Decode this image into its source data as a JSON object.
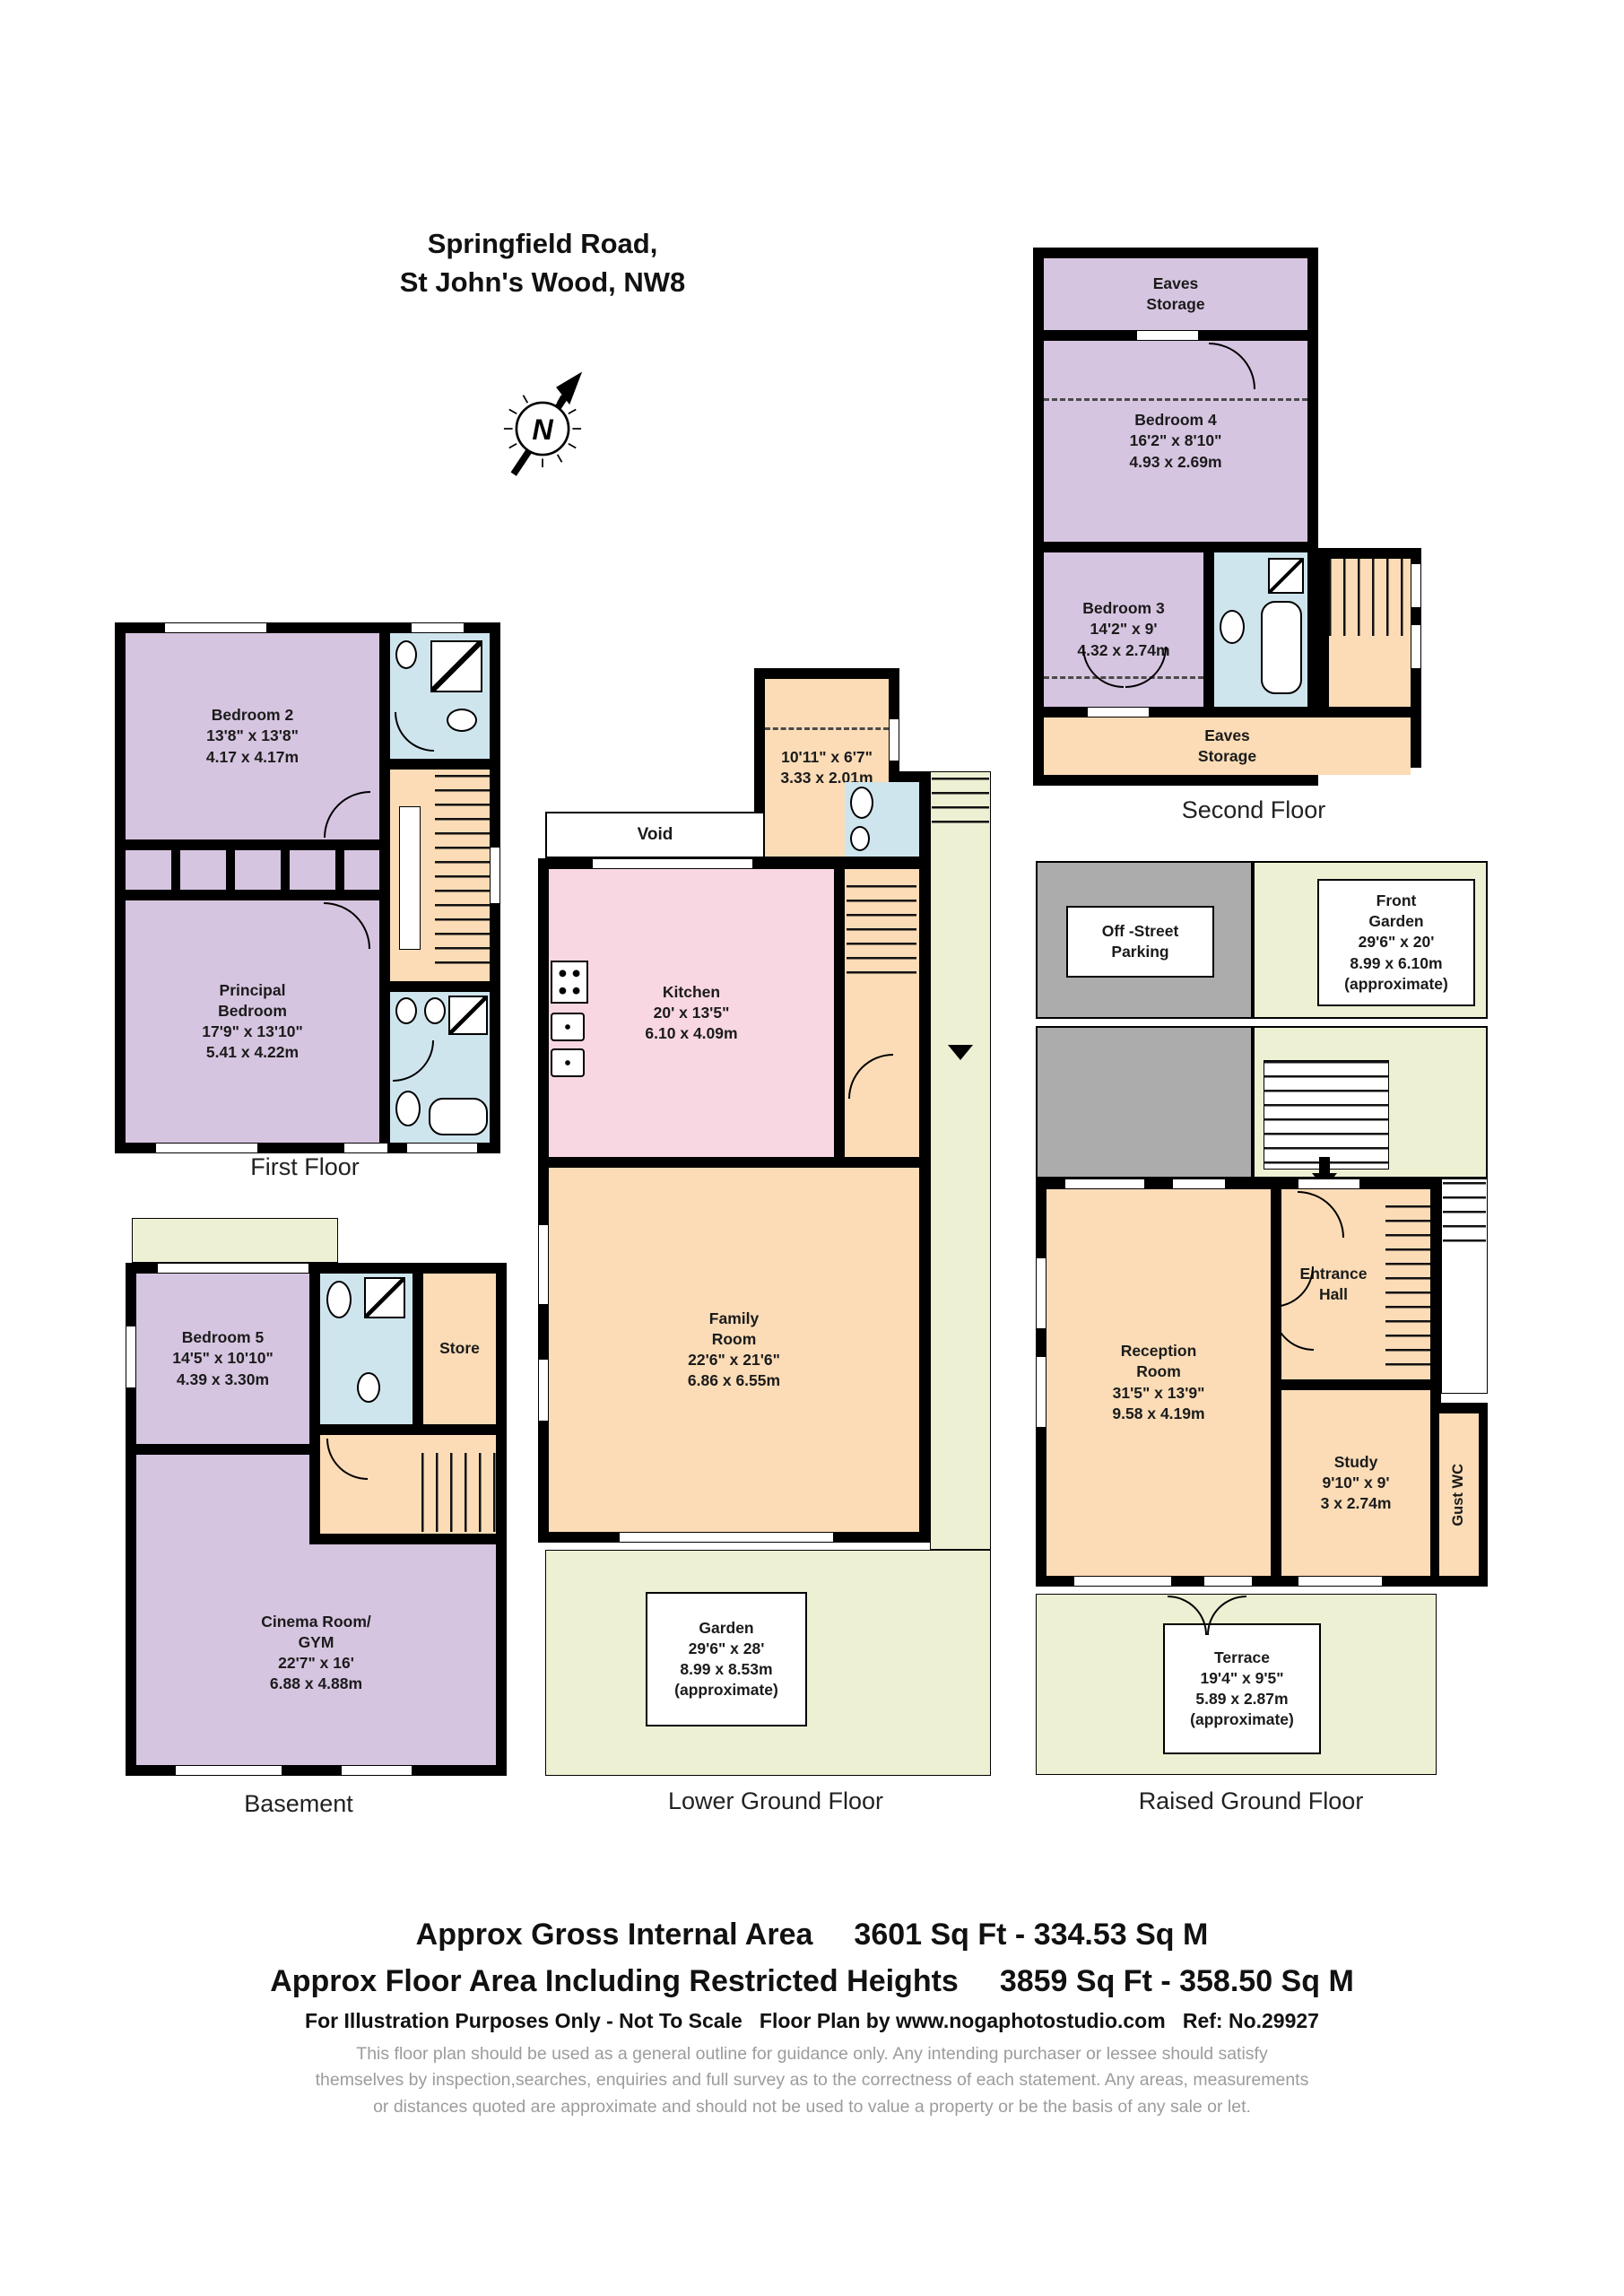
{
  "header": {
    "address": "Springfield Road,\nSt John's Wood, NW8",
    "compass_letter": "N"
  },
  "colors": {
    "bedroom_purple": "#d6c5e0",
    "hall_peach": "#fbdcb6",
    "kitchen_pink": "#f8d7e3",
    "bathroom_blue": "#cfe5ee",
    "garden_green": "#eef0d3",
    "parking_grey": "#acacac",
    "wall_black": "#000000",
    "disclaimer_grey": "#9c9c9c"
  },
  "floors": {
    "second": {
      "label": "Second Floor",
      "eaves_top": "Eaves\nStorage",
      "eaves_bottom": "Eaves\nStorage",
      "bedroom4": {
        "name": "Bedroom 4",
        "size_ft": "16'2\" x 8'10\"",
        "size_m": "4.93 x 2.69m"
      },
      "bedroom3": {
        "name": "Bedroom 3",
        "size_ft": "14'2\" x 9'",
        "size_m": "4.32 x 2.74m"
      }
    },
    "first": {
      "label": "First Floor",
      "bedroom2": {
        "name": "Bedroom 2",
        "size_ft": "13'8\" x 13'8\"",
        "size_m": "4.17 x 4.17m"
      },
      "principal": {
        "name": "Principal\nBedroom",
        "size_ft": "17'9\" x 13'10\"",
        "size_m": "5.41 x 4.22m"
      }
    },
    "lower": {
      "label": "Lower Ground Floor",
      "void": "Void",
      "box_room": {
        "size_ft": "10'11\" x 6'7\"",
        "size_m": "3.33 x 2.01m"
      },
      "kitchen": {
        "name": "Kitchen",
        "size_ft": "20' x 13'5\"",
        "size_m": "6.10 x 4.09m"
      },
      "family": {
        "name": "Family\nRoom",
        "size_ft": "22'6\" x 21'6\"",
        "size_m": "6.86 x 6.55m"
      },
      "garden": {
        "name": "Garden",
        "size_ft": "29'6\" x 28'",
        "size_m": "8.99 x 8.53m",
        "approx": "(approximate)"
      }
    },
    "raised": {
      "label": "Raised Ground Floor",
      "parking": "Off -Street\nParking",
      "front_garden": {
        "name": "Front\nGarden",
        "size_ft": "29'6\" x 20'",
        "size_m": "8.99 x 6.10m",
        "approx": "(approximate)"
      },
      "reception": {
        "name": "Reception\nRoom",
        "size_ft": "31'5\" x 13'9\"",
        "size_m": "9.58 x 4.19m"
      },
      "entrance_hall": "Entrance\nHall",
      "study": {
        "name": "Study",
        "size_ft": "9'10\" x 9'",
        "size_m": "3 x 2.74m"
      },
      "guest_wc": "Gust WC",
      "terrace": {
        "name": "Terrace",
        "size_ft": "19'4\" x 9'5\"",
        "size_m": "5.89 x 2.87m",
        "approx": "(approximate)"
      }
    },
    "basement": {
      "label": "Basement",
      "bedroom5": {
        "name": "Bedroom 5",
        "size_ft": "14'5\" x 10'10\"",
        "size_m": "4.39 x 3.30m"
      },
      "store": "Store",
      "cinema": {
        "name": "Cinema Room/\nGYM",
        "size_ft": "22'7\" x 16'",
        "size_m": "6.88 x 4.88m"
      }
    }
  },
  "footer": {
    "gia_label": "Approx Gross Internal Area",
    "gia_value": "3601 Sq Ft  -  334.53 Sq M",
    "fa_label": "Approx Floor Area Including Restricted Heights",
    "fa_value": "3859 Sq Ft  -  358.50 Sq M",
    "notice": "For Illustration Purposes Only - Not To Scale   Floor Plan by www.nogaphotostudio.com   Ref: No.29927",
    "disclaimer": "This floor plan should be used as a general outline for guidance only. Any intending purchaser or lessee should satisfy\nthemselves by inspection,searches, enquiries and full survey as to the correctness of each statement. Any areas, measurements\nor distances quoted are approximate and should not be used to value a property or be the basis of any sale or let."
  }
}
